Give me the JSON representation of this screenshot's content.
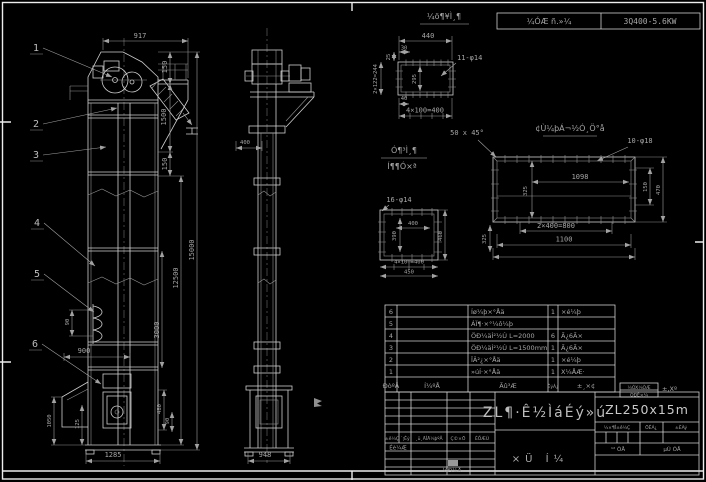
{
  "header": {
    "motor_label": "¼ÓÆ ñ.»¼",
    "motor_spec": "3Q400-5.6KW"
  },
  "balloons": {
    "b1": "1",
    "b2": "2",
    "b3": "3",
    "b4": "4",
    "b5": "5",
    "b6": "6"
  },
  "front_view": {
    "d917": "917",
    "d150a": "150",
    "d1500": "1500",
    "d150b": "150",
    "d12500": "12500",
    "d15000": "15000",
    "d3000": "3000",
    "d90a": "90",
    "d900": "900",
    "d1050": "1050",
    "d125": "125",
    "d480": "480",
    "d90b": "90",
    "d1285": "1285"
  },
  "side_view": {
    "d400": "400",
    "d948": "948"
  },
  "flange_detail": {
    "title": "¼ö¶¥Ì¸¶",
    "holes": "11-φ14",
    "d440": "440",
    "d30": "30",
    "d25": "25",
    "left": "2×122=244",
    "inner": "295",
    "d40": "40",
    "bottom": "4×100=400"
  },
  "plate_detail": {
    "title": "¢Ù¼þÁ¬½Ó¸Ö°å",
    "holes": "10-φ18",
    "d1098": "1098",
    "left": "325",
    "right1": "150",
    "right2": "470",
    "bottom1": "2×400=800",
    "bottom2": "1100"
  },
  "square_detail": {
    "holes": "16-φ14",
    "inner_w": "400",
    "inner_h": "390",
    "right": "460",
    "bottom1": "4×100=400",
    "bottom2": "450",
    "side": "325"
  },
  "notes": {
    "chamfer": "50 x 45°",
    "mid1": "Ó¶³Ì¸¶",
    "mid2": "Í¶¶Ó×ª"
  },
  "parts_table": {
    "headers": {
      "no": "ÐòºÅ",
      "code": "Í¼ºÅ",
      "name": "Ãû³Æ",
      "qty": "ÊýÁ¿",
      "remark": "±¸×¢"
    },
    "rows": [
      {
        "no": "6",
        "name": "Íø¼þ×°Åä",
        "qty": "1",
        "remark": "×é¼þ"
      },
      {
        "no": "5",
        "name": "ÁÏ¶·×°¼ô¼þ",
        "qty": "",
        "remark": ""
      },
      {
        "no": "4",
        "name": "ÖÐ¼äÍ²½Ú L=2000",
        "qty": "6",
        "remark": "Ã¿6Ã×"
      },
      {
        "no": "3",
        "name": "ÖÐ¼äÍ²½Ú L=1500mm",
        "qty": "1",
        "remark": "Ã¿6Ã×"
      },
      {
        "no": "2",
        "name": "ÏÂ²¿×°Åä",
        "qty": "1",
        "remark": "×é¼þ"
      },
      {
        "no": "1",
        "name": "»úÍ·×°Åä",
        "qty": "1",
        "remark": "X¼ÅÆ·"
      }
    ]
  },
  "title_block": {
    "main_title": "ZL¶·Ê½ÌáÉý»ú",
    "model": "ZL250x15m",
    "sheet": "×Ü Í¼",
    "rev": {
      "mark": "±ê¼Ç",
      "count": "´¦Êý",
      "doc": "¸ü¸ÄÎÄ¼þºÅ",
      "sign": "Ç©×Ö",
      "date": "ÈÕÆÚ"
    },
    "design": "Éè¼Æ",
    "date2": "¼Ð¼Å",
    "stage": "½×¶Î±ê¼Ç",
    "weight": "ÖÊÁ¿",
    "scale": "±ÈÀý",
    "sheets_total": "¹² ÕÅ",
    "sheets_no": "µÚ ÕÅ",
    "corner1": "¼ÓX¼ÒÆ",
    "corner2": "ÓÐÊ×¼",
    "corner3": "±,Xº"
  }
}
